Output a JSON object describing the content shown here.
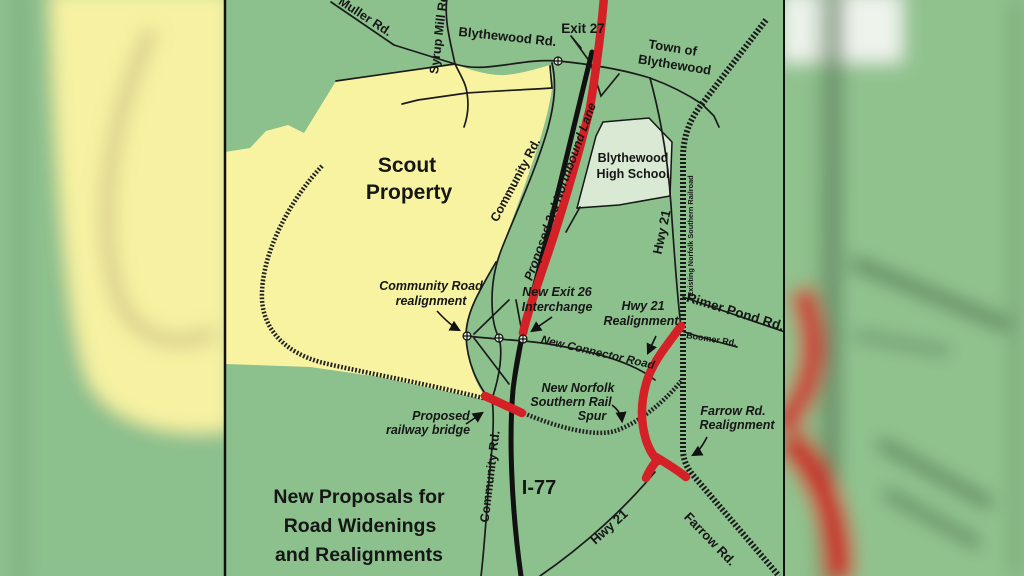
{
  "title": {
    "line1": "New Proposals for",
    "line2": "Road Widenings",
    "line3": "and Realignments"
  },
  "areas": {
    "scout": {
      "line1": "Scout",
      "line2": "Property"
    },
    "school": {
      "line1": "Blythewood",
      "line2": "High School"
    },
    "town": {
      "line1": "Town of",
      "line2": "Blythewood"
    }
  },
  "roads": {
    "muller": "Muller Rd.",
    "syrup_mill": "Syrup Mill Rd.",
    "blythewood": "Blythewood Rd.",
    "exit27": "Exit 27",
    "community_upper": "Community Rd.",
    "community_lower": "Community Rd.",
    "third_lane": "Proposed 3rd Northbound Lane",
    "hwy21_upper": "Hwy 21",
    "hwy21_lower": "Hwy 21",
    "railroad": "Existing Norfolk Southern Railroad",
    "rimer_pond": "Rimer Pond Rd.",
    "boomer": "Boomer Rd.",
    "farrow": "Farrow Rd.",
    "i77": "I-77",
    "connector": "New Connector Road"
  },
  "annotations": {
    "community_realign": {
      "line1": "Community Road",
      "line2": "realignment"
    },
    "exit26": {
      "line1": "New Exit 26",
      "line2": "Interchange"
    },
    "hwy21_realign": {
      "line1": "Hwy 21",
      "line2": "Realignment"
    },
    "rail_spur": {
      "line1": "New Norfolk",
      "line2": "Southern Rail",
      "line3": "Spur"
    },
    "farrow_realign": {
      "line1": "Farrow Rd.",
      "line2": "Realignment"
    },
    "bridge": {
      "line1": "Proposed",
      "line2": "railway bridge"
    }
  },
  "colors": {
    "map_green": "#8cc08d",
    "property_yellow": "#f8f3a1",
    "school_green": "#d9e9d4",
    "proposal_red": "#d42127",
    "road_black": "#1b1b1b"
  }
}
